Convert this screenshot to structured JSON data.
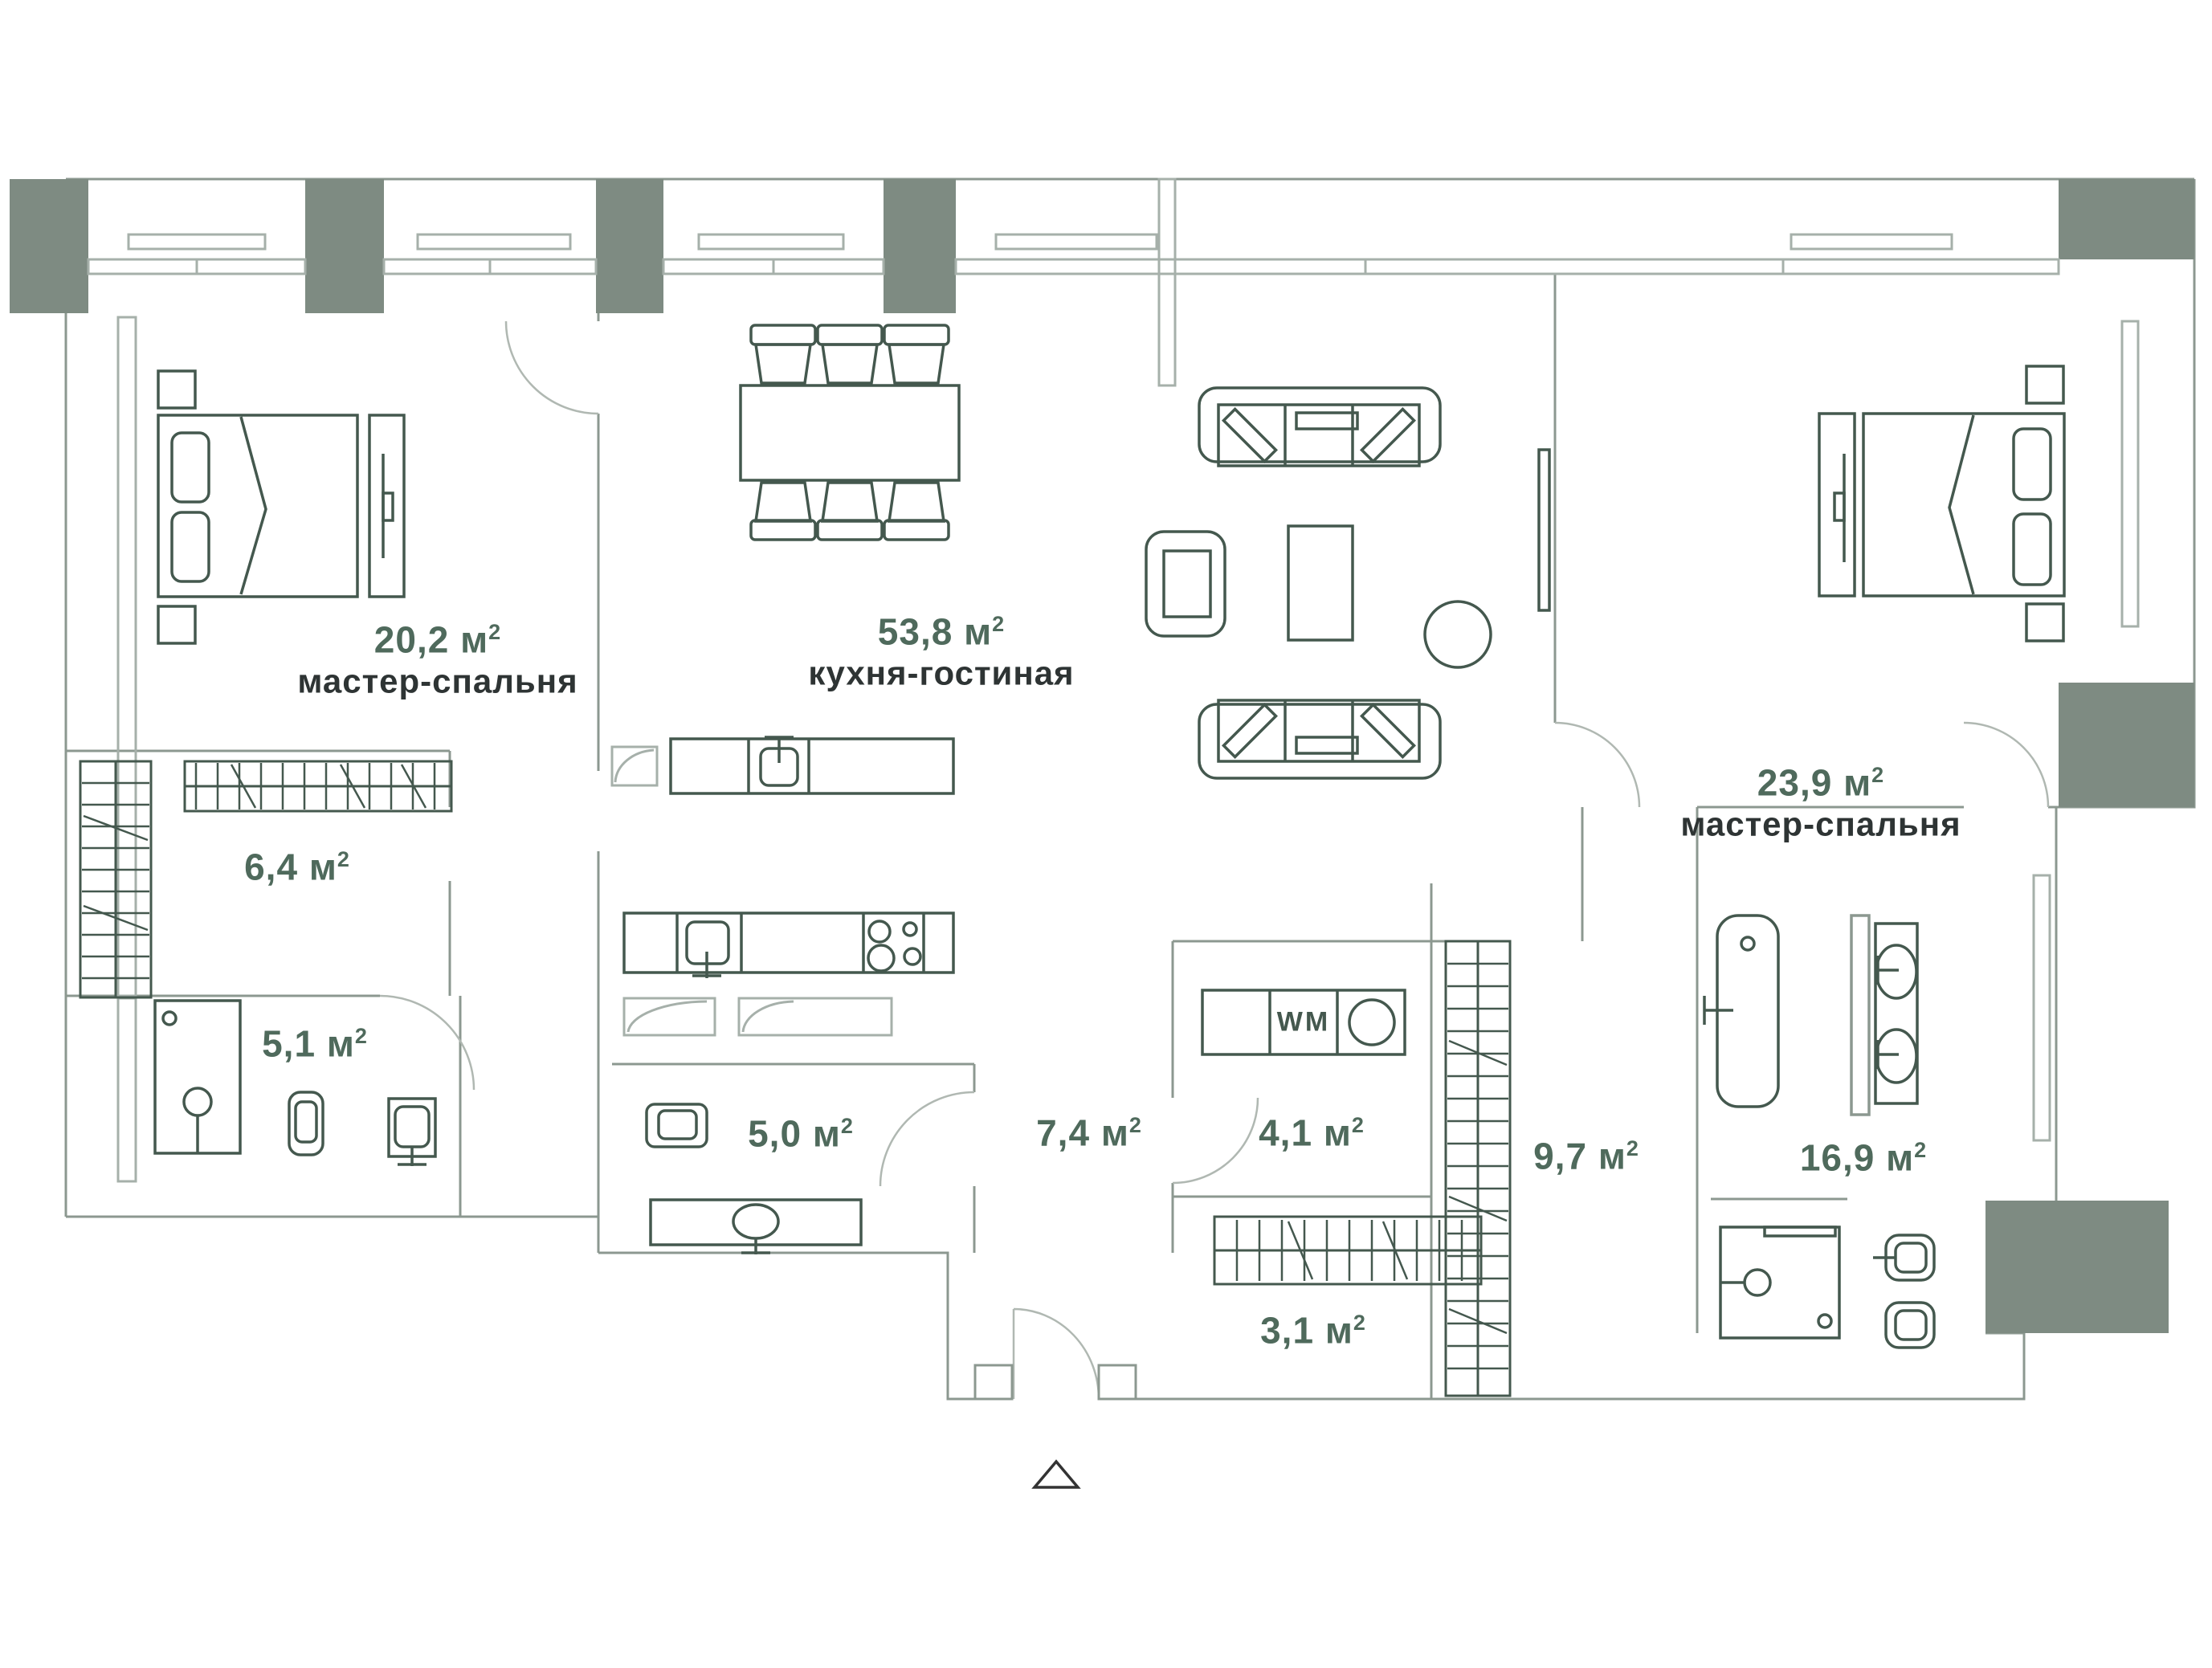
{
  "plan_title": "Floor plan of a 3-room apartment",
  "rooms": [
    {
      "id": "master-bedroom-left",
      "value": "20,2 м",
      "sup": "2",
      "name": "мастер-спальня"
    },
    {
      "id": "kitchen-living",
      "value": "53,8 м",
      "sup": "2",
      "name": "кухня-гостиная"
    },
    {
      "id": "master-bedroom-right",
      "value": "23,9 м",
      "sup": "2",
      "name": "мастер-спальня"
    },
    {
      "id": "wardrobe",
      "value": "6,4 м",
      "sup": "2",
      "name": ""
    },
    {
      "id": "bathroom-left",
      "value": "5,1 м",
      "sup": "2",
      "name": ""
    },
    {
      "id": "bathroom-guest",
      "value": "5,0 м",
      "sup": "2",
      "name": ""
    },
    {
      "id": "hallway",
      "value": "7,4 м",
      "sup": "2",
      "name": ""
    },
    {
      "id": "laundry",
      "value": "4,1 м",
      "sup": "2",
      "name": ""
    },
    {
      "id": "closet",
      "value": "3,1 м",
      "sup": "2",
      "name": ""
    },
    {
      "id": "wardrobe-corridor",
      "value": "9,7 м",
      "sup": "2",
      "name": ""
    },
    {
      "id": "master-bathroom",
      "value": "16,9 м",
      "sup": "2",
      "name": ""
    }
  ],
  "appliances": {
    "washing_machine_label": "WM"
  },
  "colors": {
    "wall": "#8c9890",
    "light_wall": "#a6b0aa",
    "furniture": "#44584e",
    "pillar": "#7e8b82",
    "area_text": "#4f6a5c",
    "name_text": "#2e3434",
    "entrance_marker": "#333333"
  }
}
